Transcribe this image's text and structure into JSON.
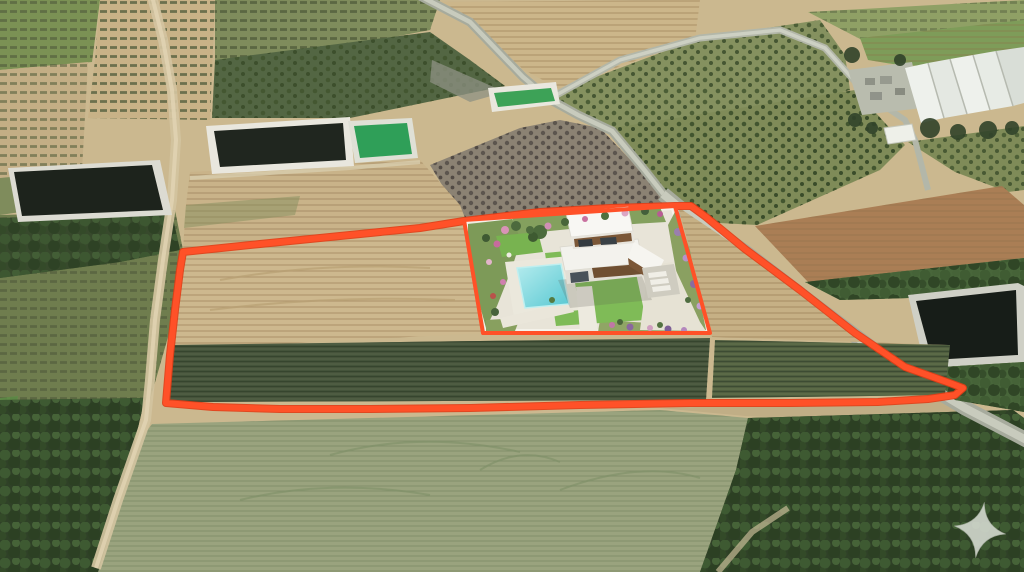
{
  "scene": {
    "canvas": {
      "width": 1024,
      "height": 572
    }
  },
  "colors": {
    "boundary": "#ff5128",
    "boundary-dark": "#e23c15",
    "star": "#d7dcd3",
    "pool": "#58c8d2",
    "pool-light": "#b5ecee",
    "lawn": "#7fbb57",
    "house-white": "#f8f7f3",
    "wood": "#7b5737",
    "tan-field": "#c8b287",
    "tan-light": "#cbb88f",
    "brown-field": "#aa7e55",
    "vineyard": "#4e5c42",
    "vineyard-stripe": "#36452e",
    "orchard": "#85915f",
    "trees-dark": "#2f4127",
    "trees-mid": "#48663a",
    "sage-field": "#9aa37e",
    "road": "#a7ab9d",
    "road-light": "#c8cbbd",
    "dirt-road": "#d3c3a0",
    "water-dark": "#20261f",
    "water-green": "#2f9f58",
    "rim-white": "#e9e7de",
    "greenhouse": "#eef1ec",
    "plot-ground": "#e8e4d8"
  },
  "boundary": {
    "outer_points": "183,252 260,244 340,236 420,228 464,221 540,212 610,208 675,206 691,206 706,217 745,249 800,290 855,333 905,367 947,382 963,388 955,395 928,399 878,402 790,403 690,403 580,405 470,408 370,409 280,409 213,407 166,403 170,355 175,310 180,270",
    "inner_points": "464,220 675,206 710,333 483,333"
  },
  "watermark": {
    "icon": "four-point-star",
    "path": "M980,502 Q983.5,525 1006,530 Q983.5,535 980,558 Q976.5,535 954,530 Q976.5,525 980,502 Z",
    "transform": "rotate(9 980 530)"
  }
}
